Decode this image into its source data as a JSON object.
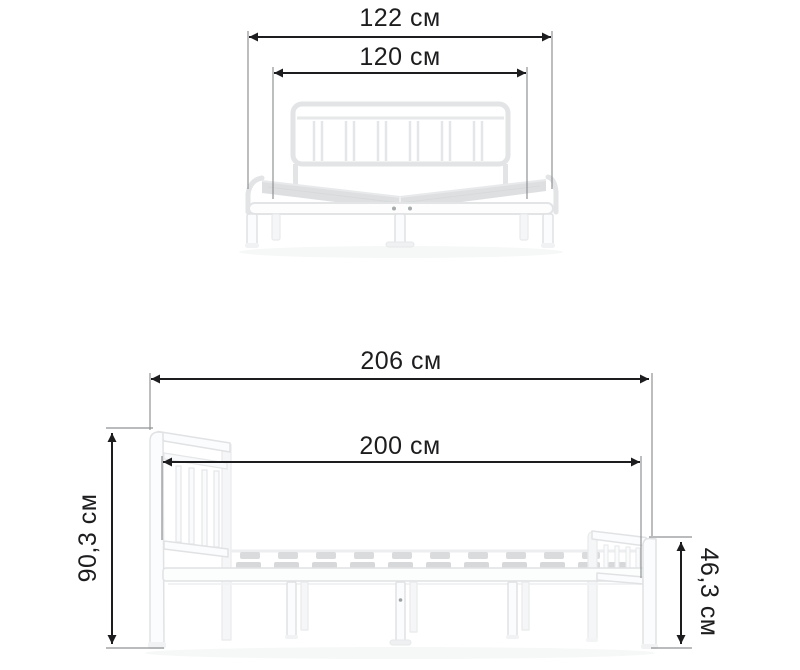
{
  "diagram_title": "bed-frame-dimensions",
  "unit": "см",
  "front_view": {
    "outer_width": {
      "label": "122 см",
      "value_cm": 122
    },
    "inner_width": {
      "label": "120 см",
      "value_cm": 120
    }
  },
  "side_view": {
    "outer_length": {
      "label": "206 см",
      "value_cm": 206
    },
    "inner_length": {
      "label": "200 см",
      "value_cm": 200
    },
    "headboard_height": {
      "label": "90,3 см",
      "value_cm": 90.3
    },
    "footboard_height": {
      "label": "46,3 см",
      "value_cm": 46.3
    }
  },
  "colors": {
    "background": "#ffffff",
    "dimension_line": "#1d1d1f",
    "extension_line": "#8f9294",
    "bed_outline": "#e2e4e6",
    "slat_fill": "#d8dadc"
  }
}
